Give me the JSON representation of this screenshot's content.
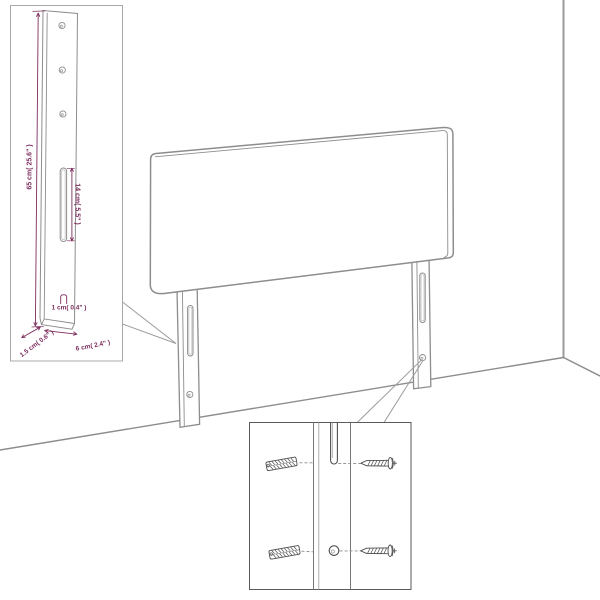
{
  "figure": {
    "type": "furniture-assembly-diagram",
    "subject": "upholstered headboard with two mounting legs shown in a room corner",
    "colors": {
      "background": "#ffffff",
      "line_gray": "#8d8d8d",
      "wall_gray": "#9b9b9b",
      "hardware_dark": "#4f4f4f",
      "inset1_border": "#a8a8a8",
      "inset2_border": "#5a5a5a",
      "dimension_text": "#7c2d5d"
    },
    "inset_top_left": {
      "name": "leg-side-view-inset",
      "description": "side view of mounting leg with three screw holes and keyhole slot",
      "dimensions": [
        {
          "id": "leg-height",
          "label": "65 cm( 25.6\" )",
          "orientation": "vertical-rotated"
        },
        {
          "id": "slot-length",
          "label": "14 cm( 5.5\" )",
          "orientation": "vertical-rotated"
        },
        {
          "id": "slot-width",
          "label": "1 cm( 0.4\" )",
          "orientation": "horizontal"
        },
        {
          "id": "leg-thickness",
          "label": "1.5 cm( 0.6\" )",
          "orientation": "diagonal"
        },
        {
          "id": "leg-depth",
          "label": "6 cm( 2.4\" )",
          "orientation": "diagonal"
        }
      ],
      "features": [
        "screw-hole-icon",
        "screw-hole-icon",
        "screw-hole-icon",
        "keyhole-slot-icon"
      ]
    },
    "inset_bottom_right": {
      "name": "mounting-hardware-inset",
      "description": "front view of leg with wall plugs and screws aligned to slot and hole",
      "features": [
        "wall-plug-icon",
        "wall-plug-icon",
        "screw-icon",
        "screw-icon",
        "keyhole-slot-icon",
        "screw-hole-icon"
      ]
    },
    "main_view": {
      "name": "headboard-perspective-view",
      "features": [
        "headboard-panel",
        "left-mounting-leg",
        "right-mounting-leg",
        "wall-corner-line",
        "floor-line"
      ]
    }
  }
}
